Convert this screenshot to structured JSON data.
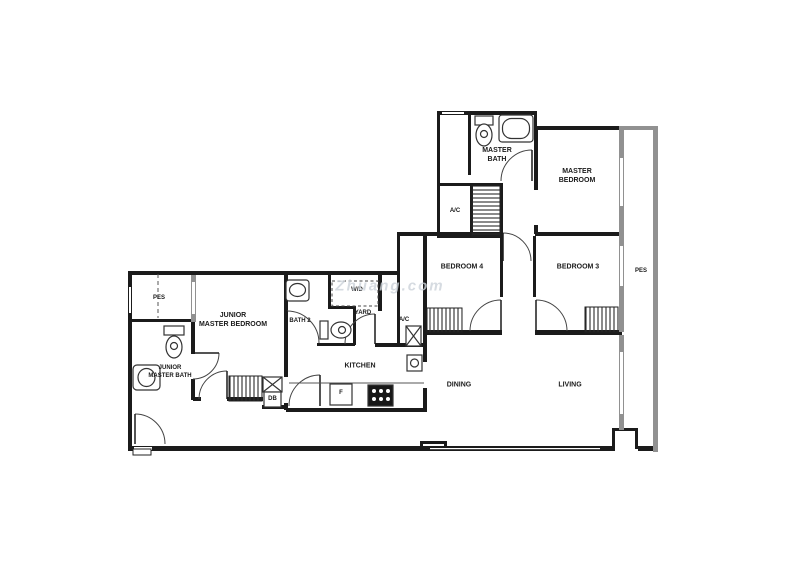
{
  "watermark": "Zhuang.com",
  "colors": {
    "wall": "#1b1b1b",
    "window_wall": "#919191",
    "door_arc": "#444444",
    "fixture": "#333333",
    "text": "#1a1a1a",
    "watermark": "#ccd3da"
  },
  "rooms": [
    {
      "id": "master-bath",
      "label": "MASTER\nBATH"
    },
    {
      "id": "master-bedroom",
      "label": "MASTER\nBEDROOM"
    },
    {
      "id": "ac-ledge-upper",
      "label": "A/C"
    },
    {
      "id": "bedroom-4",
      "label": "BEDROOM 4"
    },
    {
      "id": "bedroom-3",
      "label": "BEDROOM 3"
    },
    {
      "id": "pes-right",
      "label": "PES"
    },
    {
      "id": "pes-left",
      "label": "PES"
    },
    {
      "id": "junior-master-bedroom",
      "label": "JUNIOR\nMASTER BEDROOM"
    },
    {
      "id": "bath-2",
      "label": "BATH 2"
    },
    {
      "id": "washer-dryer",
      "label": "W/D"
    },
    {
      "id": "yard",
      "label": "YARD"
    },
    {
      "id": "ac-ledge-mid",
      "label": "A/C"
    },
    {
      "id": "kitchen",
      "label": "KITCHEN"
    },
    {
      "id": "junior-master-bath",
      "label": "JUNIOR\nMASTER BATH"
    },
    {
      "id": "db",
      "label": "DB"
    },
    {
      "id": "fridge",
      "label": "F"
    },
    {
      "id": "dining",
      "label": "DINING"
    },
    {
      "id": "living",
      "label": "LIVING"
    }
  ]
}
